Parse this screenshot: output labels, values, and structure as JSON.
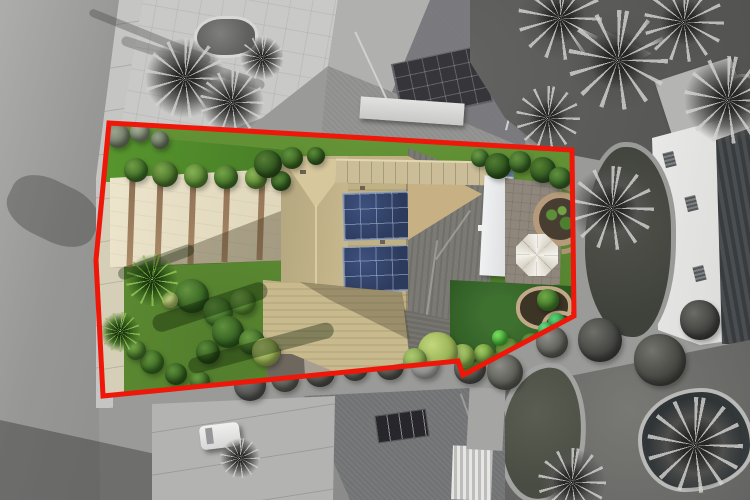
{
  "scene": {
    "kind": "aerial-drone-photo",
    "subject": "residential-property-with-highlighted-lot",
    "effect": "lot-in-color-surroundings-desaturated"
  },
  "boundary": {
    "color": "#ee1709",
    "stroke_width": 5,
    "points": [
      [
        109,
        123
      ],
      [
        572,
        150
      ],
      [
        574,
        316
      ],
      [
        463,
        375
      ],
      [
        458,
        361
      ],
      [
        103,
        396
      ],
      [
        96,
        260
      ]
    ]
  },
  "palette": {
    "boundary_red": "#ee1709",
    "lawn_green": "#679738",
    "back_lawn_green": "#2d5822",
    "driveway_beige": "#e9e1c9",
    "roof_tan": "#c6b78c",
    "roof_gray": "#7c7a74",
    "solar_panel_blue": "#2c3a5c",
    "road_gray": "#9a9a9a",
    "pool_dark": "#2c3133",
    "patio_cover_white": "#eef0f1"
  },
  "vegetation": {
    "outside_palms": [
      {
        "x": 185,
        "y": 78,
        "r": 40
      },
      {
        "x": 232,
        "y": 102,
        "r": 32
      },
      {
        "x": 262,
        "y": 58,
        "r": 22
      },
      {
        "x": 560,
        "y": 18,
        "r": 42
      },
      {
        "x": 618,
        "y": 60,
        "r": 50
      },
      {
        "x": 684,
        "y": 22,
        "r": 40
      },
      {
        "x": 728,
        "y": 100,
        "r": 44
      },
      {
        "x": 548,
        "y": 118,
        "r": 32
      },
      {
        "x": 612,
        "y": 208,
        "r": 42
      },
      {
        "x": 695,
        "y": 445,
        "r": 48
      },
      {
        "x": 572,
        "y": 482,
        "r": 34
      },
      {
        "x": 240,
        "y": 458,
        "r": 20
      }
    ],
    "outside_bushes": [
      {
        "x": 250,
        "y": 385,
        "r": 16,
        "c1": "#7b7b79",
        "c2": "#4e4e4c"
      },
      {
        "x": 285,
        "y": 378,
        "r": 14,
        "c1": "#85857f",
        "c2": "#55554f"
      },
      {
        "x": 320,
        "y": 372,
        "r": 15,
        "c1": "#7e7e78",
        "c2": "#4a4a46"
      },
      {
        "x": 355,
        "y": 368,
        "r": 13,
        "c1": "#8a8a84",
        "c2": "#52524c"
      },
      {
        "x": 390,
        "y": 366,
        "r": 14,
        "c1": "#7f7f79",
        "c2": "#4c4c48"
      },
      {
        "x": 425,
        "y": 364,
        "r": 15,
        "c1": "#8888822",
        "c2": "#50504a"
      },
      {
        "x": 470,
        "y": 368,
        "r": 16,
        "c1": "#83837d",
        "c2": "#4b4b47"
      },
      {
        "x": 505,
        "y": 372,
        "r": 18,
        "c1": "#8d8d87",
        "c2": "#54544e"
      },
      {
        "x": 552,
        "y": 342,
        "r": 16,
        "c1": "#90908a",
        "c2": "#575751"
      },
      {
        "x": 600,
        "y": 340,
        "r": 22,
        "c1": "#6f6f69",
        "c2": "#3f3f3d"
      },
      {
        "x": 660,
        "y": 360,
        "r": 26,
        "c1": "#74746e",
        "c2": "#42423e"
      },
      {
        "x": 700,
        "y": 320,
        "r": 20,
        "c1": "#6c6c66",
        "c2": "#3c3c3a"
      }
    ],
    "inside_palms": [
      {
        "x": 152,
        "y": 280,
        "r": 26
      },
      {
        "x": 120,
        "y": 332,
        "r": 20
      }
    ],
    "inside_bushes": [
      {
        "x": 118,
        "y": 136,
        "r": 12,
        "c1": "#9aa48e",
        "c2": "#6f7a64"
      },
      {
        "x": 140,
        "y": 132,
        "r": 10,
        "c1": "#a3ad97",
        "c2": "#7a8570"
      },
      {
        "x": 160,
        "y": 140,
        "r": 9,
        "c1": "#93a087",
        "c2": "#697560"
      },
      {
        "x": 136,
        "y": 170,
        "r": 12,
        "c1": "#6f9c44",
        "c2": "#3a6a25"
      },
      {
        "x": 165,
        "y": 174,
        "r": 13,
        "c1": "#7aa44a",
        "c2": "#456f28"
      },
      {
        "x": 196,
        "y": 176,
        "r": 12,
        "c1": "#86b054",
        "c2": "#51822e"
      },
      {
        "x": 226,
        "y": 177,
        "r": 12,
        "c1": "#74a247",
        "c2": "#3f7026"
      },
      {
        "x": 256,
        "y": 178,
        "r": 11,
        "c1": "#8cb458",
        "c2": "#57842f"
      },
      {
        "x": 281,
        "y": 181,
        "r": 10,
        "c1": "#639440",
        "c2": "#2f5a1e"
      },
      {
        "x": 192,
        "y": 296,
        "r": 17,
        "c1": "#649340",
        "c2": "#33611f"
      },
      {
        "x": 218,
        "y": 312,
        "r": 15,
        "c1": "#6e9d46",
        "c2": "#3c6d26"
      },
      {
        "x": 243,
        "y": 302,
        "r": 13,
        "c1": "#7fab50",
        "c2": "#4e7e2c"
      },
      {
        "x": 228,
        "y": 332,
        "r": 16,
        "c1": "#5f8f3c",
        "c2": "#2f5a1e"
      },
      {
        "x": 252,
        "y": 342,
        "r": 13,
        "c1": "#6c9a44",
        "c2": "#3a6a24"
      },
      {
        "x": 266,
        "y": 352,
        "r": 14,
        "c1": "#bccf7a",
        "c2": "#93a84e"
      },
      {
        "x": 208,
        "y": 352,
        "r": 12,
        "c1": "#5c8c3a",
        "c2": "#2c541b"
      },
      {
        "x": 152,
        "y": 362,
        "r": 12,
        "c1": "#669640",
        "c2": "#36661f"
      },
      {
        "x": 176,
        "y": 374,
        "r": 11,
        "c1": "#5e8e3c",
        "c2": "#2e5a1c"
      },
      {
        "x": 200,
        "y": 381,
        "r": 10,
        "c1": "#6a9a42",
        "c2": "#3a6a24"
      },
      {
        "x": 136,
        "y": 350,
        "r": 10,
        "c1": "#74a348",
        "c2": "#447327"
      },
      {
        "x": 170,
        "y": 300,
        "r": 8,
        "c1": "#c8d98a",
        "c2": "#a8b964"
      },
      {
        "x": 268,
        "y": 164,
        "r": 14,
        "c1": "#557e34",
        "c2": "#2b4f1c"
      },
      {
        "x": 292,
        "y": 158,
        "r": 11,
        "c1": "#61913e",
        "c2": "#36611f"
      },
      {
        "x": 316,
        "y": 156,
        "r": 9,
        "c1": "#5a8a38",
        "c2": "#2f5a1e"
      },
      {
        "x": 480,
        "y": 158,
        "r": 9,
        "c1": "#6a9a46",
        "c2": "#3a6a28"
      },
      {
        "x": 498,
        "y": 166,
        "r": 13,
        "c1": "#527c32",
        "c2": "#284e1b"
      },
      {
        "x": 520,
        "y": 162,
        "r": 11,
        "c1": "#639040",
        "c2": "#346024"
      },
      {
        "x": 543,
        "y": 170,
        "r": 13,
        "c1": "#568030",
        "c2": "#2b5220"
      },
      {
        "x": 560,
        "y": 178,
        "r": 11,
        "c1": "#619040",
        "c2": "#326024"
      },
      {
        "x": 548,
        "y": 300,
        "r": 11,
        "c1": "#6fa647",
        "c2": "#3f7a28"
      },
      {
        "x": 557,
        "y": 322,
        "r": 9,
        "c1": "#5cd07a",
        "c2": "#2ea043"
      },
      {
        "x": 546,
        "y": 330,
        "r": 8,
        "c1": "#66d983",
        "c2": "#35b14c"
      },
      {
        "x": 532,
        "y": 344,
        "r": 11,
        "c1": "#6c9c44",
        "c2": "#3c7026"
      },
      {
        "x": 508,
        "y": 350,
        "r": 12,
        "c1": "#85b252",
        "c2": "#55862f"
      },
      {
        "x": 500,
        "y": 338,
        "r": 8,
        "c1": "#79dd60",
        "c2": "#49b535"
      },
      {
        "x": 484,
        "y": 354,
        "r": 10,
        "c1": "#9fc763",
        "c2": "#6f9c3c"
      },
      {
        "x": 463,
        "y": 356,
        "r": 12,
        "c1": "#b2cc72",
        "c2": "#82a647"
      },
      {
        "x": 438,
        "y": 352,
        "r": 20,
        "c1": "#c3d77e",
        "c2": "#93ad4f"
      },
      {
        "x": 415,
        "y": 360,
        "r": 12,
        "c1": "#adc970",
        "c2": "#7da04a"
      }
    ]
  }
}
